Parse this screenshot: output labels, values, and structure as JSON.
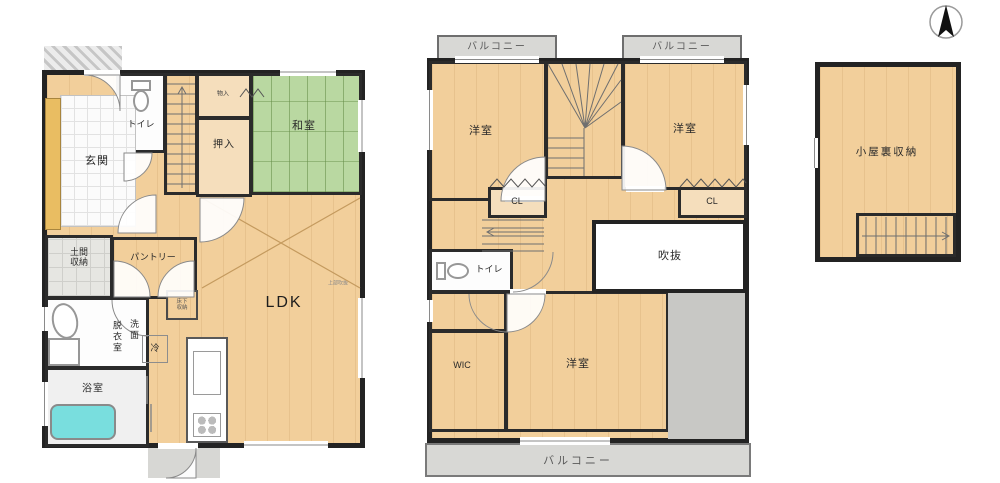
{
  "compass": {
    "label": "north-arrow"
  },
  "floor1": {
    "genkan": "玄関",
    "toilet": "トイレ",
    "monoire": "物入",
    "oshiire": "押入",
    "washitsu": "和室",
    "ldk": "LDK",
    "doma_storage": "土間収納",
    "pantry": "パントリー",
    "senmen": "洗面",
    "datsuishitsu": "脱衣室",
    "fridge": "冷",
    "bath": "浴室",
    "underfloor_storage": "床下収納",
    "void_note": "上部吹抜"
  },
  "floor2": {
    "balcony_top_left": "バルコニー",
    "balcony_top_right": "バルコニー",
    "balcony_bottom": "バルコニー",
    "bedroom_left": "洋室",
    "bedroom_right": "洋室",
    "bedroom_bottom": "洋室",
    "closet_left": "CL",
    "closet_right": "CL",
    "void": "吹抜",
    "toilet": "トイレ",
    "wic": "WIC"
  },
  "attic": {
    "label": "小屋裏収納"
  },
  "colors": {
    "wall": "#232323",
    "wood": "#f2cf9b",
    "tatami": "#b9d8a1",
    "balcony_gray": "#d8d8d5",
    "tub_cyan": "#79dede",
    "entry_yellow": "#e9bd62"
  }
}
